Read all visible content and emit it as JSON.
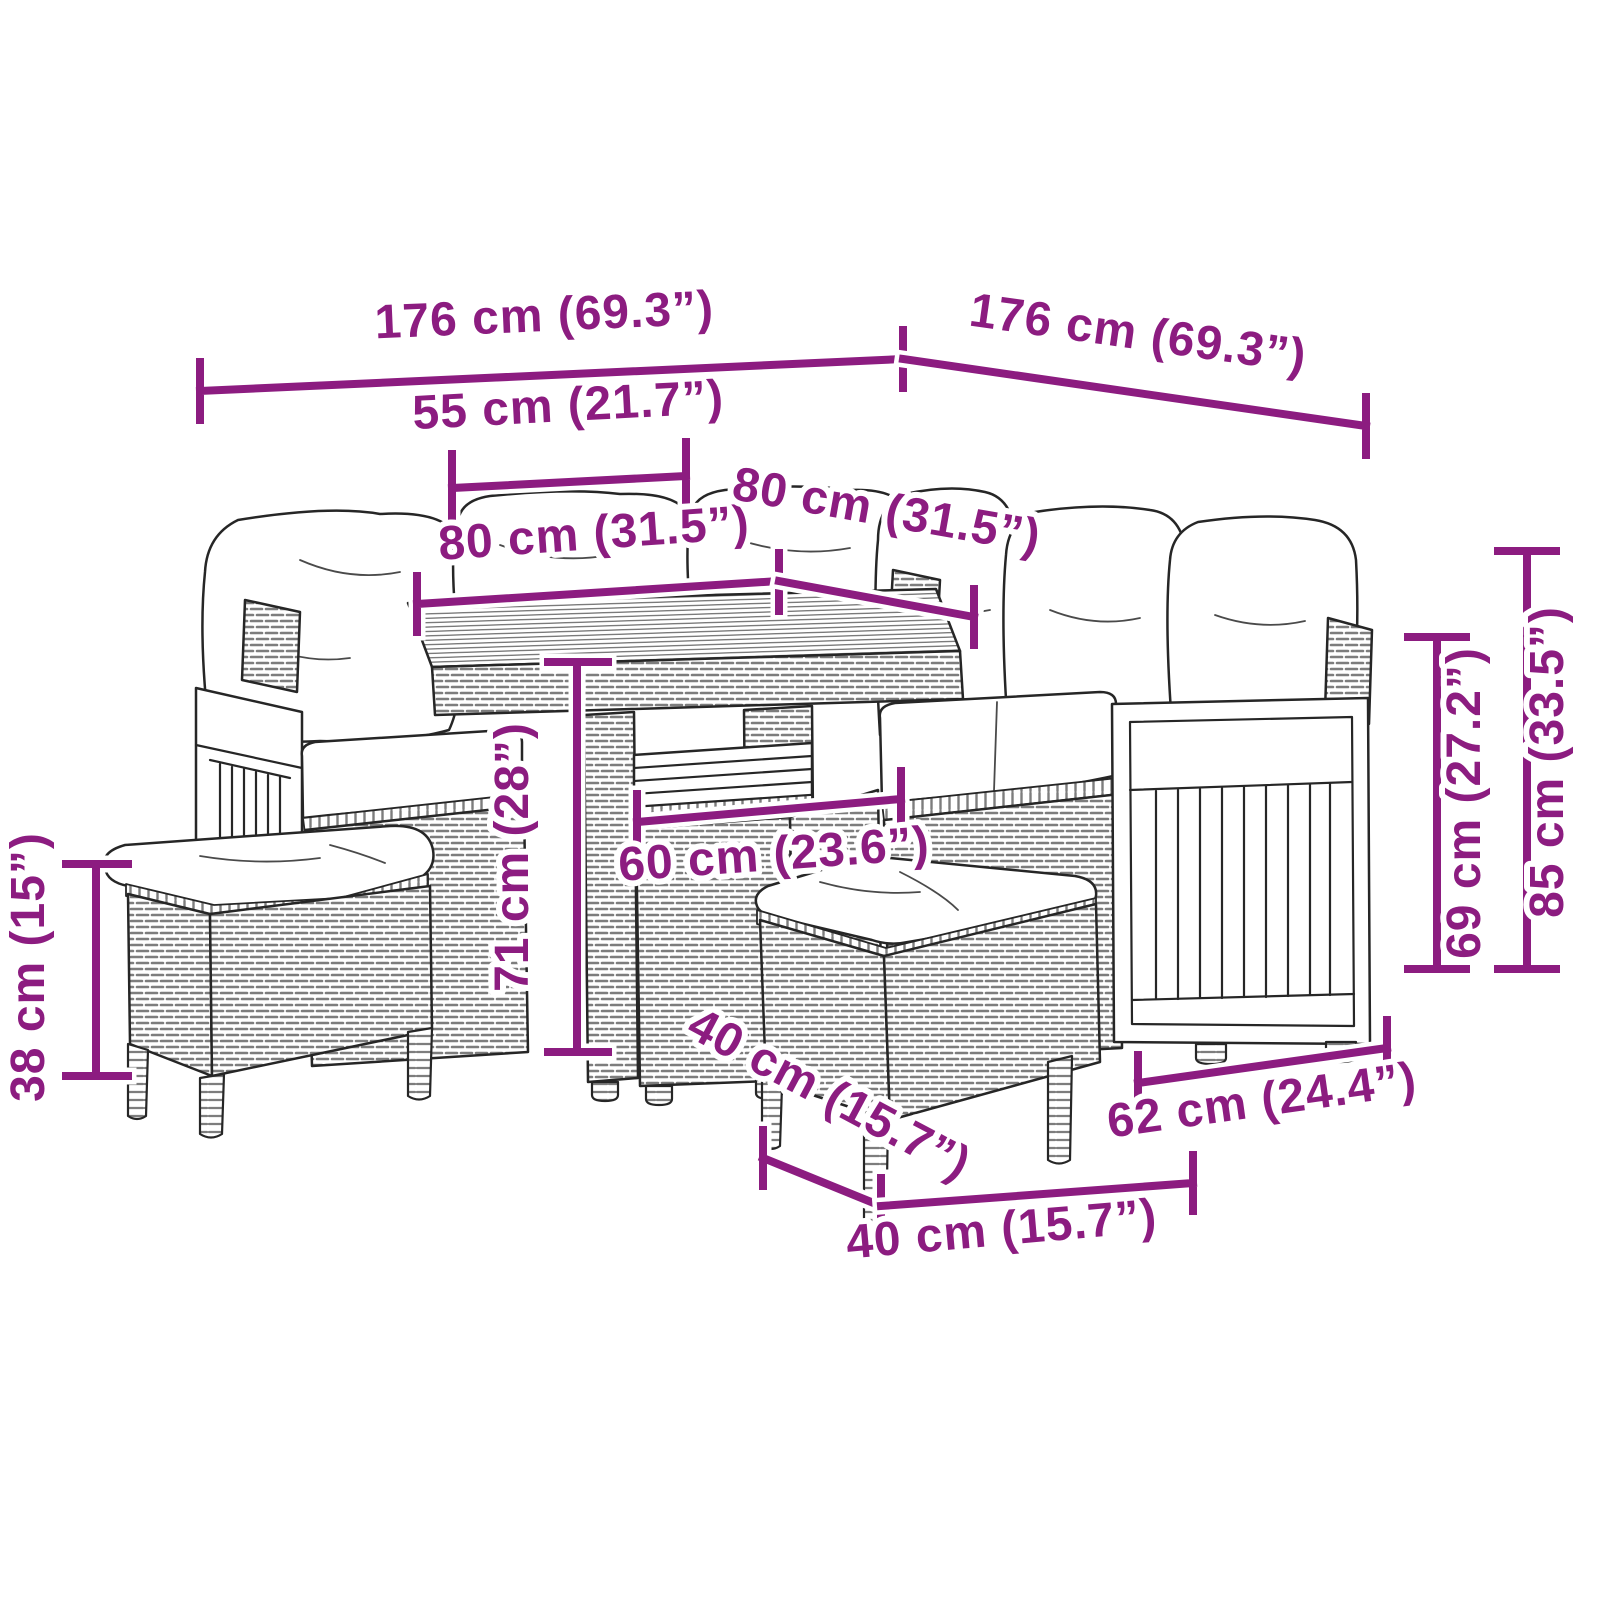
{
  "diagram": {
    "accent_color": "#8C1C80",
    "artwork_line_color": "#262626",
    "dimensions": {
      "sofa_width_left": "176 cm (69.3”)",
      "sofa_width_right": "176 cm (69.3”)",
      "table_top_width": "55 cm (21.7”)",
      "seat_section_left": "80 cm (31.5”)",
      "seat_section_right": "80 cm (31.5”)",
      "table_height": "71 cm (28”)",
      "table_depth": "60 cm (23.6”)",
      "stool_height": "38 cm (15”)",
      "armrest_panel_height": "69 cm (27.2”)",
      "sofa_back_height": "85 cm (33.5”)",
      "stool_depth": "40 cm (15.7”)",
      "stool_width": "40 cm (15.7”)",
      "armrest_panel_width": "62 cm (24.4”)"
    }
  }
}
